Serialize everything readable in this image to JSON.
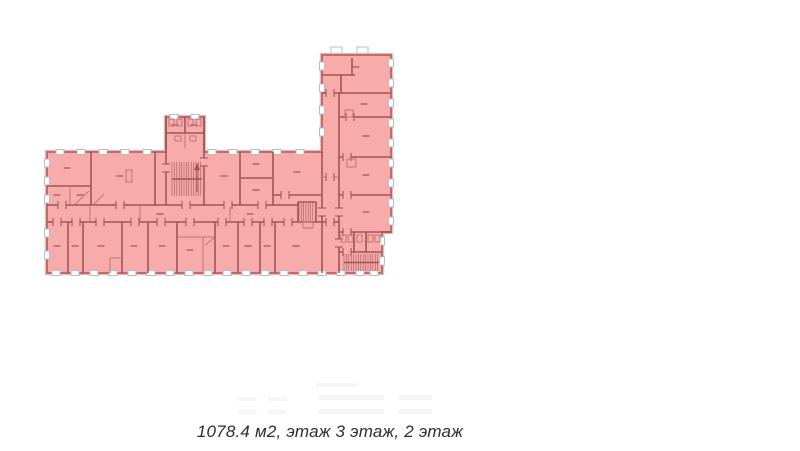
{
  "caption": {
    "text": "1078.4 м2, этаж 3 этаж, 2 этаж"
  },
  "floorplan": {
    "colors": {
      "background": "#ffffff",
      "highlight_fill": "#f8abab",
      "outline_stroke": "#ca6767",
      "wall": "#a05555",
      "partition": "#c07575",
      "outer_wall": "#c9c9c9",
      "window_fill": "#ffffff",
      "window_stroke": "#bbbbbb",
      "door_tick": "#9a4f4f",
      "dash": "#bd6b6b",
      "faint": "#f6f6f6"
    },
    "outline": "47,152 166,152 166,117 204,117 204,152 322,152 322,55 391,55 391,232 382,232 382,273 47,273",
    "notches": [
      [
        331,
        47,
        11,
        9
      ],
      [
        357,
        47,
        11,
        9
      ]
    ],
    "faint_blocks": [
      [
        238,
        397,
        19,
        4
      ],
      [
        268,
        397,
        19,
        4
      ],
      [
        318,
        395,
        66,
        5
      ],
      [
        398,
        395,
        34,
        5
      ],
      [
        238,
        410,
        19,
        4
      ],
      [
        268,
        410,
        19,
        4
      ],
      [
        318,
        409,
        66,
        5
      ],
      [
        398,
        409,
        34,
        5
      ],
      [
        316,
        383,
        42,
        4
      ]
    ],
    "windows": [
      [
        "h",
        60,
        152
      ],
      [
        "h",
        81,
        152
      ],
      [
        "h",
        103,
        152
      ],
      [
        "h",
        125,
        152
      ],
      [
        "h",
        147,
        152
      ],
      [
        "h",
        212,
        152
      ],
      [
        "h",
        233,
        152
      ],
      [
        "h",
        255,
        152
      ],
      [
        "h",
        277,
        152
      ],
      [
        "h",
        300,
        152
      ],
      [
        "h",
        174,
        117
      ],
      [
        "h",
        195,
        117
      ],
      [
        "v",
        47,
        163
      ],
      [
        "v",
        47,
        181
      ],
      [
        "v",
        47,
        199
      ],
      [
        "v",
        47,
        233
      ],
      [
        "v",
        47,
        255
      ],
      [
        "h",
        56,
        273
      ],
      [
        "h",
        75,
        273
      ],
      [
        "h",
        94,
        273
      ],
      [
        "h",
        113,
        273
      ],
      [
        "h",
        132,
        273
      ],
      [
        "h",
        151,
        273
      ],
      [
        "h",
        170,
        273
      ],
      [
        "h",
        189,
        273
      ],
      [
        "h",
        208,
        273
      ],
      [
        "h",
        227,
        273
      ],
      [
        "h",
        246,
        273
      ],
      [
        "h",
        265,
        273
      ],
      [
        "h",
        284,
        273
      ],
      [
        "h",
        303,
        273
      ],
      [
        "h",
        322,
        273
      ],
      [
        "h",
        341,
        273
      ],
      [
        "h",
        360,
        273
      ],
      [
        "h",
        374,
        273
      ],
      [
        "v",
        322,
        66
      ],
      [
        "v",
        322,
        88
      ],
      [
        "v",
        322,
        110
      ],
      [
        "v",
        322,
        132
      ],
      [
        "v",
        391,
        63
      ],
      [
        "v",
        391,
        83
      ],
      [
        "v",
        391,
        103
      ],
      [
        "v",
        391,
        123
      ],
      [
        "v",
        391,
        143
      ],
      [
        "v",
        391,
        163
      ],
      [
        "v",
        391,
        183
      ],
      [
        "v",
        391,
        203
      ],
      [
        "v",
        391,
        221
      ],
      [
        "v",
        382,
        241
      ],
      [
        "v",
        382,
        261
      ]
    ],
    "walls": [
      [
        91,
        152,
        91,
        205
      ],
      [
        155,
        152,
        155,
        205
      ],
      [
        166,
        117,
        166,
        205
      ],
      [
        204,
        117,
        204,
        205
      ],
      [
        240,
        152,
        240,
        205
      ],
      [
        273,
        152,
        273,
        205
      ],
      [
        322,
        152,
        322,
        273
      ],
      [
        339,
        93,
        339,
        273
      ],
      [
        47,
        186,
        91,
        186
      ],
      [
        240,
        178,
        273,
        178
      ],
      [
        273,
        195,
        322,
        195
      ],
      [
        47,
        205,
        298,
        205
      ],
      [
        47,
        222,
        339,
        222
      ],
      [
        166,
        133,
        204,
        133
      ],
      [
        185,
        117,
        185,
        133
      ],
      [
        322,
        75,
        355,
        75
      ],
      [
        352,
        58,
        352,
        75
      ],
      [
        341,
        75,
        341,
        93
      ],
      [
        322,
        93,
        391,
        93
      ],
      [
        339,
        117,
        391,
        117
      ],
      [
        339,
        157,
        391,
        157
      ],
      [
        339,
        195,
        391,
        195
      ],
      [
        339,
        232,
        391,
        232
      ],
      [
        339,
        252,
        382,
        252
      ],
      [
        354,
        232,
        354,
        252
      ],
      [
        366,
        232,
        366,
        252
      ],
      [
        68,
        222,
        68,
        273
      ],
      [
        83,
        222,
        83,
        273
      ],
      [
        122,
        222,
        122,
        273
      ],
      [
        148,
        222,
        148,
        273
      ],
      [
        177,
        222,
        177,
        273
      ],
      [
        215,
        222,
        215,
        273
      ],
      [
        238,
        222,
        238,
        273
      ],
      [
        260,
        222,
        260,
        273
      ],
      [
        275,
        222,
        275,
        273
      ],
      [
        298,
        202,
        316,
        202
      ],
      [
        298,
        202,
        298,
        222
      ],
      [
        316,
        202,
        316,
        222
      ]
    ],
    "partitions": [
      [
        70,
        186,
        70,
        205
      ],
      [
        110,
        258,
        122,
        258
      ],
      [
        110,
        258,
        110,
        273
      ],
      [
        177,
        237,
        215,
        237
      ],
      [
        203,
        237,
        203,
        273
      ],
      [
        185,
        133,
        185,
        148
      ],
      [
        322,
        177,
        339,
        177
      ],
      [
        90,
        205,
        90,
        222
      ],
      [
        140,
        205,
        140,
        222
      ],
      [
        230,
        205,
        230,
        222
      ]
    ],
    "diagonals": [
      [
        74,
        205,
        89,
        191
      ],
      [
        93,
        205,
        104,
        194
      ],
      [
        205,
        245,
        214,
        238
      ]
    ],
    "doors": [
      [
        "h",
        62,
        205
      ],
      [
        "h",
        120,
        205
      ],
      [
        "h",
        186,
        205
      ],
      [
        "h",
        228,
        205
      ],
      [
        "h",
        262,
        205
      ],
      [
        "h",
        57,
        222
      ],
      [
        "h",
        76,
        222
      ],
      [
        "h",
        100,
        222
      ],
      [
        "h",
        135,
        222
      ],
      [
        "h",
        161,
        222
      ],
      [
        "h",
        190,
        222
      ],
      [
        "h",
        222,
        222
      ],
      [
        "h",
        248,
        222
      ],
      [
        "h",
        268,
        222
      ],
      [
        "h",
        288,
        222
      ],
      [
        "h",
        330,
        222
      ],
      [
        "h",
        285,
        195
      ],
      [
        "h",
        330,
        177
      ],
      [
        "h",
        330,
        93
      ],
      [
        "h",
        350,
        117
      ],
      [
        "h",
        347,
        157
      ],
      [
        "h",
        347,
        195
      ],
      [
        "h",
        347,
        232
      ],
      [
        "h",
        347,
        252
      ],
      [
        "v",
        166,
        168
      ],
      [
        "v",
        204,
        162
      ],
      [
        "v",
        339,
        212
      ],
      [
        "v",
        339,
        243
      ],
      [
        "v",
        322,
        212
      ]
    ],
    "stairs": [
      {
        "x1": 172,
        "y1": 162,
        "x2": 202,
        "y2": 196,
        "step": 2.4,
        "midline": true
      },
      {
        "x1": 299,
        "y1": 203,
        "x2": 315,
        "y2": 221,
        "step": 2.3,
        "midline": false
      },
      {
        "x1": 344,
        "y1": 254,
        "x2": 379,
        "y2": 271,
        "step": 2.4,
        "midline": true
      }
    ],
    "stair_arrow": {
      "line": [
        197,
        192,
        197,
        167
      ],
      "head": "194,170 200,170 197,163"
    },
    "fixtures": [
      [
        169,
        119,
        5,
        7
      ],
      [
        177,
        119,
        5,
        7
      ],
      [
        188,
        119,
        5,
        7
      ],
      [
        196,
        119,
        5,
        7
      ],
      [
        175,
        136,
        6,
        5
      ],
      [
        190,
        136,
        6,
        5
      ],
      [
        347,
        159,
        9,
        8
      ],
      [
        345,
        110,
        8,
        7
      ],
      [
        303,
        222,
        10,
        6
      ],
      [
        341,
        235,
        5,
        7
      ],
      [
        348,
        235,
        5,
        7
      ],
      [
        357,
        235,
        5,
        7
      ],
      [
        368,
        235,
        5,
        7
      ],
      [
        375,
        235,
        5,
        7
      ],
      [
        126,
        170,
        6,
        12
      ]
    ],
    "dashes": [
      [
        67,
        168
      ],
      [
        120,
        176
      ],
      [
        224,
        176
      ],
      [
        256,
        164
      ],
      [
        256,
        190
      ],
      [
        297,
        172
      ],
      [
        57,
        195
      ],
      [
        80,
        195
      ],
      [
        160,
        214
      ],
      [
        250,
        214
      ],
      [
        175,
        125
      ],
      [
        194,
        125
      ],
      [
        356,
        67
      ],
      [
        364,
        104
      ],
      [
        366,
        136
      ],
      [
        366,
        175
      ],
      [
        366,
        212
      ],
      [
        57,
        246
      ],
      [
        75,
        246
      ],
      [
        101,
        246
      ],
      [
        134,
        246
      ],
      [
        162,
        246
      ],
      [
        190,
        250
      ],
      [
        226,
        246
      ],
      [
        248,
        246
      ],
      [
        267,
        246
      ],
      [
        296,
        246
      ]
    ]
  }
}
